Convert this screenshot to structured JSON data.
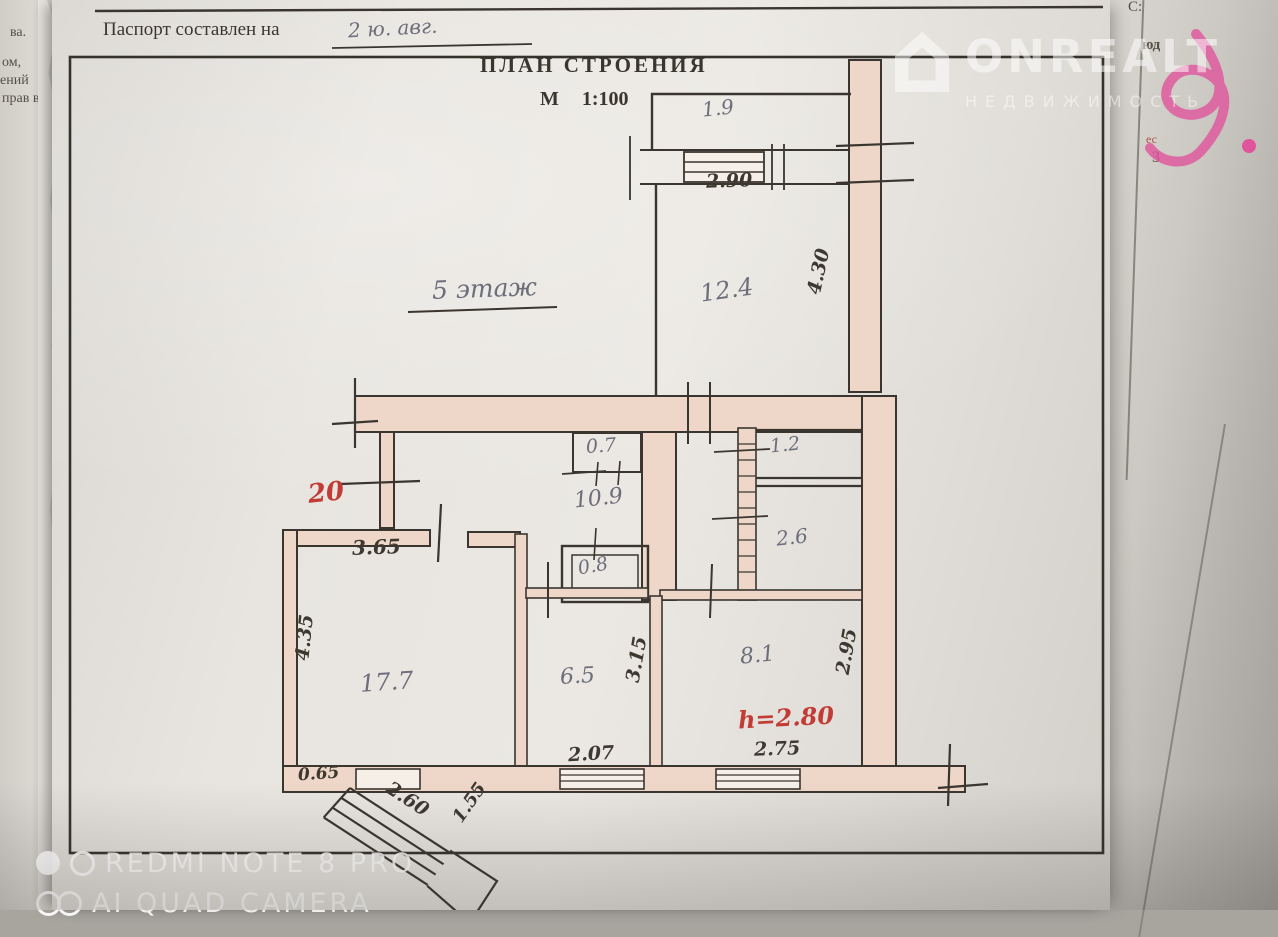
{
  "document": {
    "passport_label": "Паспорт составлен на",
    "passport_value": "2 ю. авг.",
    "title": "ПЛАН СТРОЕНИЯ",
    "scale": "М 1:100",
    "floor_note": "5 этаж"
  },
  "plan": {
    "areas": {
      "balcony_top": "1.9",
      "room_12_4": "12.4",
      "pantry_0_7": "0.7",
      "closet_1_2": "1.2",
      "hallway_10_9": "10.9",
      "bath_2_6": "2.6",
      "wc_0_8": "0.8",
      "living_17_7": "17.7",
      "kitchen_6_5": "6.5",
      "bedroom_8_1": "8.1"
    },
    "dims": {
      "balcony_width": "2.90",
      "room_12_4_depth": "4.30",
      "hall_width": "3.65",
      "living_depth": "4.35",
      "kitchen_depth": "3.15",
      "bedroom_depth": "2.95",
      "kitchen_width": "2.07",
      "bedroom_width": "2.75",
      "corner_offset": "0.65",
      "stairs_run": "2.60",
      "stairs_side": "1.55"
    },
    "red_notes": {
      "unit_number": "20",
      "ceiling_height": "h=2.80"
    },
    "colors": {
      "wall_fill": "#eed7c8",
      "line": "#3a362f",
      "pencil": "#6e6e7a",
      "red_note": "#c23b35",
      "pink_marker": "#e0549c"
    }
  },
  "watermark": {
    "brand": "ONREALT",
    "tagline": "НЕДВИЖИМОСТЬ"
  },
  "camera": {
    "line1": "REDMI NOTE 8 PRO",
    "line2": "AI QUAD CAMERA"
  },
  "fragments": {
    "left": [
      "ва.",
      "ом,",
      "ений",
      "прав в"
    ],
    "right_top": "С:",
    "right_a": "юд",
    "right_b": "ес",
    "right_c": "3"
  }
}
